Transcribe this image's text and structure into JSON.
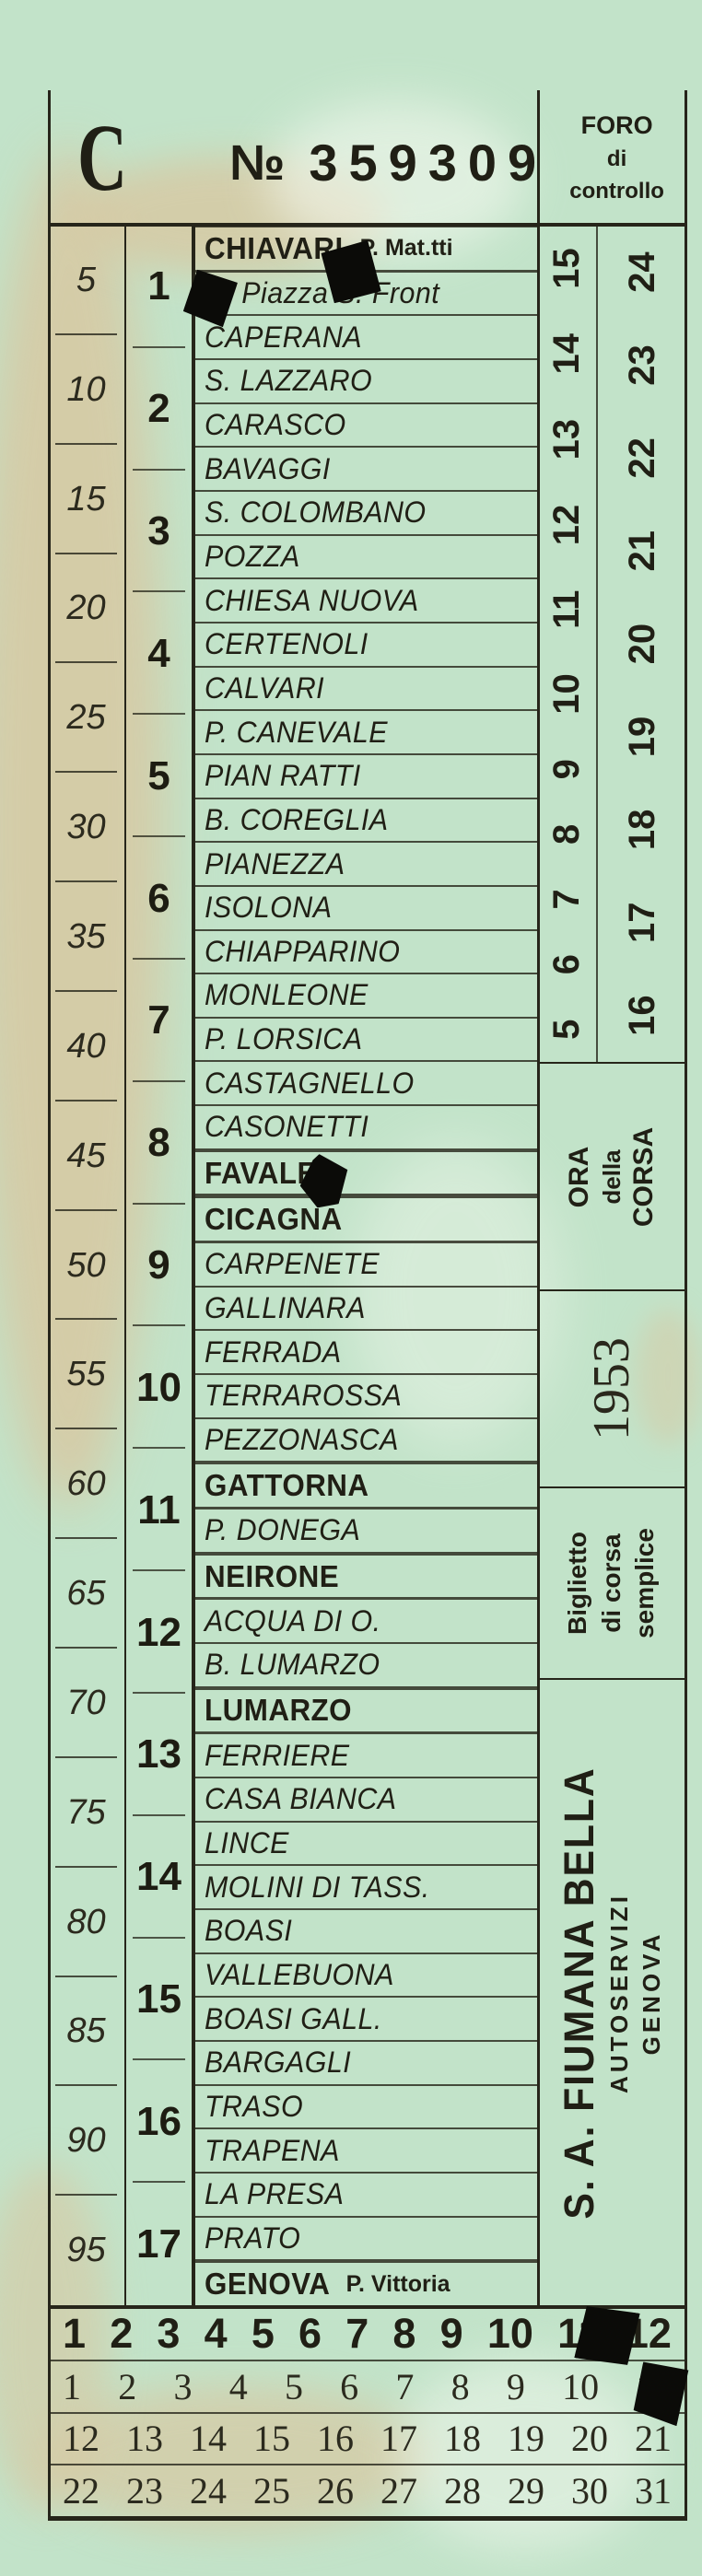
{
  "header": {
    "series_letter": "C",
    "serial_prefix": "№",
    "serial_number": "359309",
    "control_label_lines": [
      "FORO",
      "di",
      "controllo"
    ]
  },
  "fare_column": {
    "values": [
      "5",
      "10",
      "15",
      "20",
      "25",
      "30",
      "35",
      "40",
      "45",
      "50",
      "55",
      "60",
      "65",
      "70",
      "75",
      "80",
      "85",
      "90",
      "95"
    ]
  },
  "zone_column": {
    "values": [
      "1",
      "2",
      "3",
      "4",
      "5",
      "6",
      "7",
      "8",
      "9",
      "10",
      "11",
      "12",
      "13",
      "14",
      "15",
      "16",
      "17"
    ]
  },
  "stations": [
    {
      "label": "CHIAVARI",
      "sub": "P. Mat.tti",
      "major": true
    },
    {
      "label": "RI Piazza S. Front"
    },
    {
      "label": "CAPERANA"
    },
    {
      "label": "S. LAZZARO"
    },
    {
      "label": "CARASCO"
    },
    {
      "label": "BAVAGGI"
    },
    {
      "label": "S. COLOMBANO"
    },
    {
      "label": "POZZA"
    },
    {
      "label": "CHIESA NUOVA"
    },
    {
      "label": "CERTENOLI"
    },
    {
      "label": "CALVARI"
    },
    {
      "label": "P. CANEVALE"
    },
    {
      "label": "PIAN RATTI"
    },
    {
      "label": "B. COREGLIA"
    },
    {
      "label": "PIANEZZA"
    },
    {
      "label": "ISOLONA"
    },
    {
      "label": "CHIAPPARINO"
    },
    {
      "label": "MONLEONE"
    },
    {
      "label": "P. LORSICA"
    },
    {
      "label": "CASTAGNELLO"
    },
    {
      "label": "CASONETTI"
    },
    {
      "label": "FAVALE",
      "major": true
    },
    {
      "label": "CICAGNA",
      "major": true
    },
    {
      "label": "CARPENETE"
    },
    {
      "label": "GALLINARA"
    },
    {
      "label": "FERRADA"
    },
    {
      "label": "TERRAROSSA"
    },
    {
      "label": "PEZZONASCA"
    },
    {
      "label": "GATTORNA",
      "major": true
    },
    {
      "label": "P. DONEGA"
    },
    {
      "label": "NEIRONE",
      "major": true
    },
    {
      "label": "ACQUA DI O."
    },
    {
      "label": "B. LUMARZO"
    },
    {
      "label": "LUMARZO",
      "major": true
    },
    {
      "label": "FERRIERE"
    },
    {
      "label": "CASA BIANCA"
    },
    {
      "label": "LINCE"
    },
    {
      "label": "MOLINI DI TASS."
    },
    {
      "label": "BOASI"
    },
    {
      "label": "VALLEBUONA"
    },
    {
      "label": "BOASI GALL."
    },
    {
      "label": "BARGAGLI"
    },
    {
      "label": "TRASO"
    },
    {
      "label": "TRAPENA"
    },
    {
      "label": "LA PRESA"
    },
    {
      "label": "PRATO"
    },
    {
      "label": "GENOVA",
      "sub": "P. Vittoria",
      "major": true
    }
  ],
  "hours_column": {
    "inner_numbers": [
      "5",
      "6",
      "7",
      "8",
      "9",
      "10",
      "11",
      "12",
      "13",
      "14",
      "15"
    ],
    "outer_numbers": [
      "16",
      "17",
      "18",
      "19",
      "20",
      "21",
      "22",
      "23",
      "24"
    ],
    "ora_label_lines": [
      "ORA",
      "della",
      "CORSA"
    ],
    "year": "1953",
    "ticket_type_lines": [
      "Biglietto",
      "di corsa",
      "semplice"
    ],
    "company_name": "S. A. FIUMANA BELLA",
    "company_sub_lines": [
      "AUTOSERVIZI",
      "GENOVA"
    ]
  },
  "bottom_grid": {
    "row1": [
      "1",
      "2",
      "3",
      "4",
      "5",
      "6",
      "7",
      "8",
      "9",
      "10",
      "11",
      "12"
    ],
    "row2": [
      "1",
      "2",
      "3",
      "4",
      "5",
      "6",
      "7",
      "8",
      "9",
      "10",
      "11"
    ],
    "row3": [
      "12",
      "13",
      "14",
      "15",
      "16",
      "17",
      "18",
      "19",
      "20",
      "21"
    ],
    "row4": [
      "22",
      "23",
      "24",
      "25",
      "26",
      "27",
      "28",
      "29",
      "30",
      "31"
    ]
  },
  "punch_holes": [
    "over zone column near 1",
    "over CHIAVARI station row",
    "over FAVALE station row",
    "over 11 in bold top grid row",
    "over 11 in second grid row"
  ],
  "colors": {
    "paper": "#c2e3c9",
    "ink": "#26251a",
    "stain": "#d8c8a2",
    "punch": "#0b0b08"
  }
}
